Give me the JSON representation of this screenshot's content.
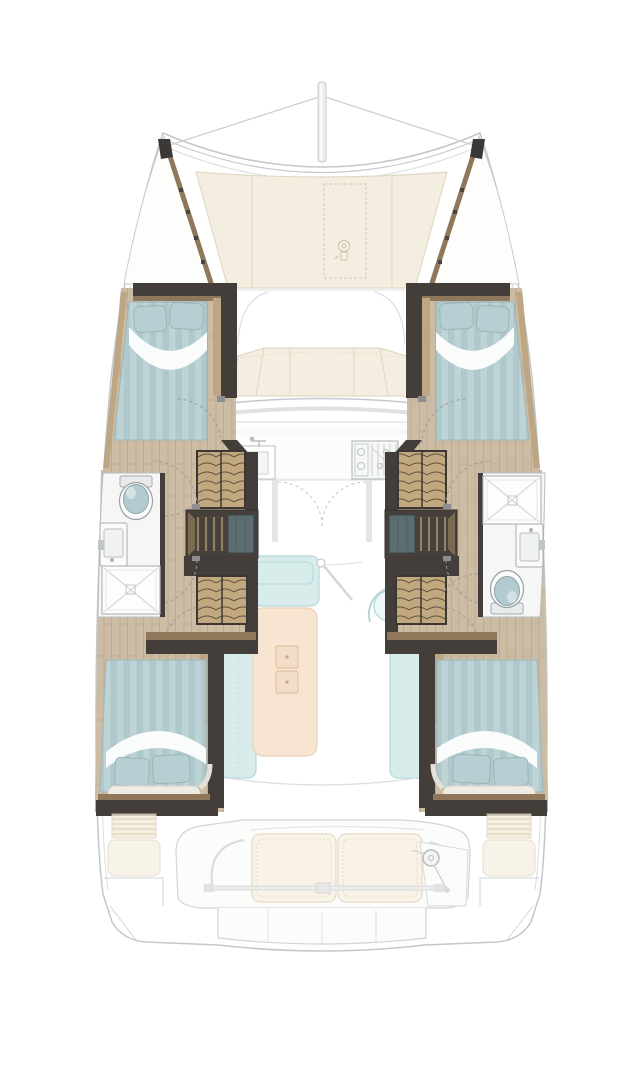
{
  "canvas": {
    "width": 643,
    "height": 1080
  },
  "diagram": {
    "kind": "catamaran-interior-floorplan",
    "orientation": "bow-up",
    "areas": [
      "mast",
      "foredeck",
      "anchor-locker-hatch",
      "port-bow-locker",
      "starboard-bow-locker",
      "port-forward-cabin",
      "starboard-forward-cabin",
      "port-head",
      "starboard-head",
      "port-wardrobes",
      "starboard-wardrobes",
      "port-companionway-steps",
      "starboard-companionway-steps",
      "forward-seating",
      "windshield",
      "galley",
      "salon",
      "salon-table",
      "port-aft-cabin",
      "starboard-aft-cabin",
      "cockpit",
      "cockpit-bench",
      "helm-station",
      "transom-platform"
    ],
    "icons": [
      "windlass-icon",
      "helm-wheel-icon",
      "toilet-icon",
      "sink-icon",
      "faucet-icon",
      "shower-icon",
      "stove-icon",
      "door-swing-icon"
    ],
    "fixtures": {
      "beds": 4,
      "heads": 2,
      "showers": 2,
      "toilets": 2,
      "helm_wheels": 1
    }
  },
  "colors": {
    "background": "#ffffff",
    "outline": "#c3c7c9",
    "outline_soft": "#dcdedf",
    "ghost_line": "#d2d4d5",
    "ghost_fill": "#fcfcfb",
    "cream": "#f4eee0",
    "cream_border": "#e1d9c6",
    "wall_dark": "#433e3a",
    "wall_darker": "#35312d",
    "trim_brown": "#8e775b",
    "trim_light": "#bda684",
    "wood": "#cdbca4",
    "wood_line": "#b8a78e",
    "bed": "#afc8cb",
    "bed_stripe": "#bdd3d5",
    "sheet": "#fafcfc",
    "pillow": "#b7cfd2",
    "pillow_line": "#9db4b7",
    "cane": "#c2a87e",
    "cane_line": "#5f5140",
    "steps_bg": "#46403b",
    "steps_tread": "#93805f",
    "steps_panel": "#5b6d70",
    "bath_floor": "#f5f6f5",
    "fixture": "#a7abad",
    "toilet_lid": "#b2cbd0",
    "salon_teal": "#d8ecec",
    "salon_teal_line": "#b6d7d8",
    "table_peach": "#f7e4d1",
    "table_line": "#ecd0b6",
    "door_arc": "#9b9b9b",
    "locker_stripe": "#d9c8a6"
  }
}
